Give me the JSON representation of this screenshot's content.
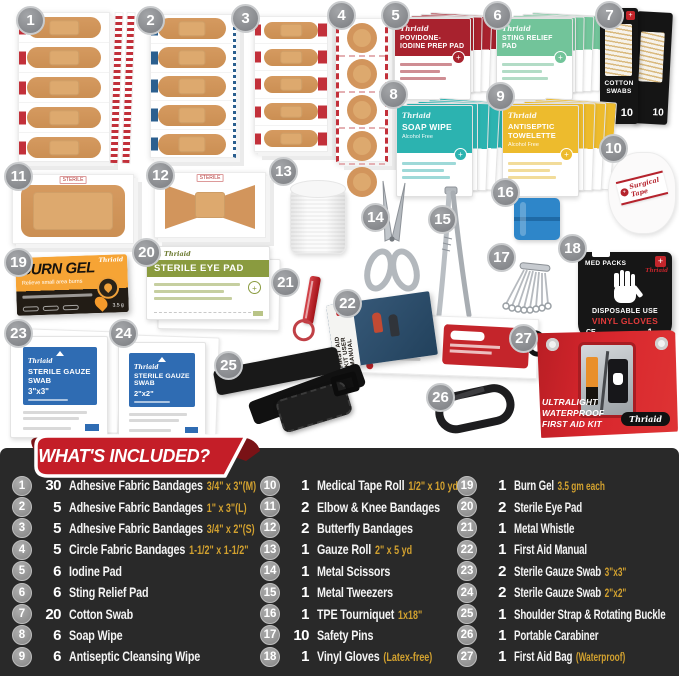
{
  "brand": "Thriaid",
  "banner": {
    "title": "WHAT'S INCLUDED?"
  },
  "colors": {
    "ribbon_red": "#c41e28",
    "ribbon_fold": "#7a1216",
    "panel_bg": "#292929",
    "accent_gold": "#d2a12f",
    "badge_gray": "#8e9094",
    "iodine_red": "#a8222e",
    "sting_green": "#72c49a",
    "soap_teal": "#2cb3b0",
    "towelette_yellow": "#edbb2d",
    "eyepad_green": "#8a9b3f",
    "gauze_blue": "#2f6cb3",
    "bag_red": "#d02428",
    "bandage_tan": "#d2955c"
  },
  "products": {
    "p1": {
      "num": "1"
    },
    "p2": {
      "num": "2"
    },
    "p3": {
      "num": "3"
    },
    "p4": {
      "num": "4"
    },
    "p5": {
      "num": "5",
      "title": "POVIDONE-IODINE PREP PAD"
    },
    "p6": {
      "num": "6",
      "title": "STING RELIEF PAD"
    },
    "p7": {
      "num": "7",
      "title": "COTTON SWABS",
      "count": "10"
    },
    "p8": {
      "num": "8",
      "title": "SOAP WIPE",
      "sub": "Alcohol Free"
    },
    "p9": {
      "num": "9",
      "title": "ANTISEPTIC TOWELETTE",
      "sub": "Alcohol Free"
    },
    "p10": {
      "num": "10",
      "title": "Surgical Tape"
    },
    "p11": {
      "num": "11",
      "tag": "STERILE"
    },
    "p12": {
      "num": "12",
      "tag": "STERILE"
    },
    "p13": {
      "num": "13"
    },
    "p14": {
      "num": "14"
    },
    "p15": {
      "num": "15"
    },
    "p16": {
      "num": "16"
    },
    "p17": {
      "num": "17"
    },
    "p18": {
      "num": "18",
      "maker": "MED PACKS",
      "line1": "DISPOSABLE USE",
      "line2": "VINYL GLOVES",
      "ce": "CE",
      "count": "1",
      "count_unit": "pair"
    },
    "p19": {
      "num": "19",
      "title": "BURN GEL",
      "sub": "Relieve small area burns",
      "weight": "3.5 g"
    },
    "p20": {
      "num": "20",
      "title": "STERILE EYE PAD"
    },
    "p21": {
      "num": "21"
    },
    "p22": {
      "num": "22",
      "line1": "FIRST AID KIT",
      "line2": "USER MANUAL"
    },
    "p23": {
      "num": "23",
      "title": "STERILE GAUZE SWAB",
      "size": "3\"x3\""
    },
    "p24": {
      "num": "24",
      "title": "STERILE GAUZE SWAB",
      "size": "2\"x2\""
    },
    "p25": {
      "num": "25"
    },
    "p26": {
      "num": "26"
    },
    "p27": {
      "num": "27",
      "line1": "ULTRALIGHT",
      "line2": "WATERPROOF",
      "line3": "FIRST AID KIT"
    }
  },
  "list": {
    "col1": [
      {
        "num": "1",
        "qty": "30",
        "label": "Adhesive Fabric Bandages",
        "note": "3/4\" x 3\"(M)"
      },
      {
        "num": "2",
        "qty": "5",
        "label": "Adhesive Fabric Bandages",
        "note": "1\" x 3\"(L)"
      },
      {
        "num": "3",
        "qty": "5",
        "label": "Adhesive Fabric Bandages",
        "note": "3/4\" x 2\"(S)"
      },
      {
        "num": "4",
        "qty": "5",
        "label": "Circle Fabric Bandages",
        "note": "1-1/2\" x 1-1/2\""
      },
      {
        "num": "5",
        "qty": "6",
        "label": "Iodine Pad"
      },
      {
        "num": "6",
        "qty": "6",
        "label": "Sting Relief Pad"
      },
      {
        "num": "7",
        "qty": "20",
        "label": "Cotton Swab"
      },
      {
        "num": "8",
        "qty": "6",
        "label": "Soap Wipe"
      },
      {
        "num": "9",
        "qty": "6",
        "label": "Antiseptic Cleansing Wipe"
      }
    ],
    "col2": [
      {
        "num": "10",
        "qty": "1",
        "label": "Medical Tape Roll",
        "note": "1/2\" x 10 yd"
      },
      {
        "num": "11",
        "qty": "2",
        "label": "Elbow & Knee Bandages"
      },
      {
        "num": "12",
        "qty": "2",
        "label": "Butterfly Bandages"
      },
      {
        "num": "13",
        "qty": "1",
        "label": "Gauze Roll",
        "note": "2\" x 5 yd"
      },
      {
        "num": "14",
        "qty": "1",
        "label": "Metal Scissors"
      },
      {
        "num": "15",
        "qty": "1",
        "label": "Metal Tweezers"
      },
      {
        "num": "16",
        "qty": "1",
        "label": "TPE Tourniquet",
        "note": "1x18\""
      },
      {
        "num": "17",
        "qty": "10",
        "label": "Safety Pins"
      },
      {
        "num": "18",
        "qty": "1",
        "label": "Vinyl Gloves",
        "note": "(Latex-free)"
      }
    ],
    "col3": [
      {
        "num": "19",
        "qty": "1",
        "label": "Burn Gel",
        "note": "3.5 gm each"
      },
      {
        "num": "20",
        "qty": "2",
        "label": "Sterile Eye Pad"
      },
      {
        "num": "21",
        "qty": "1",
        "label": "Metal Whistle"
      },
      {
        "num": "22",
        "qty": "1",
        "label": "First Aid Manual"
      },
      {
        "num": "23",
        "qty": "2",
        "label": "Sterile Gauze Swab",
        "note": "3\"x3\""
      },
      {
        "num": "24",
        "qty": "2",
        "label": "Sterile Gauze Swab",
        "note": "2\"x2\""
      },
      {
        "num": "25",
        "qty": "1",
        "label": "Shoulder Strap & Rotating Buckle"
      },
      {
        "num": "26",
        "qty": "1",
        "label": "Portable Carabiner"
      },
      {
        "num": "27",
        "qty": "1",
        "label": "First Aid Bag",
        "note": "(Waterproof)"
      }
    ]
  }
}
